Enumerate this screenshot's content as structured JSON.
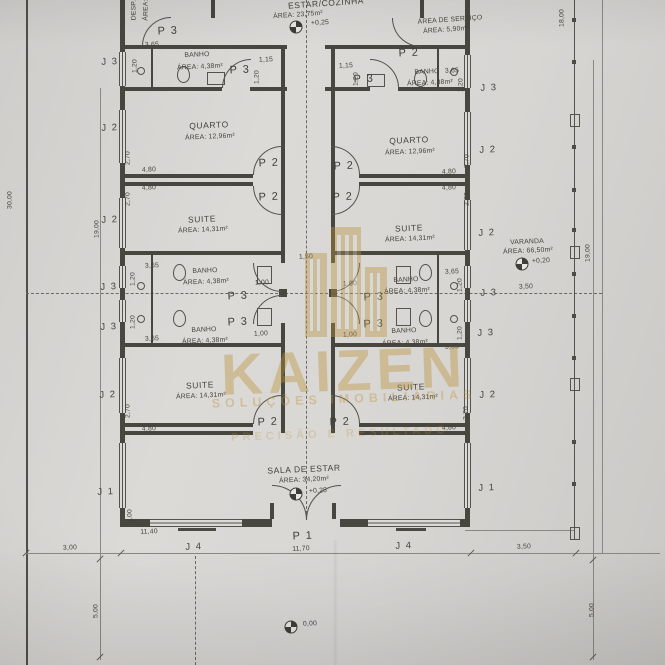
{
  "watermark": {
    "brand": "KAIZEN",
    "tagline": "SOLUÇÕES IMOBILIÁRIAS",
    "tagline2": "PRECISÃO E RESULTADO",
    "color": "#bb943c"
  },
  "plan": {
    "line_color": "#47463f",
    "paper_color": "#d8d6d3",
    "labels": [
      {
        "n": "room-despensa-name",
        "t": "DESP.",
        "x": 134,
        "y": 10,
        "r": -90,
        "k": "dim"
      },
      {
        "n": "room-despensa-area",
        "t": "ÁREA:",
        "x": 146,
        "y": 10,
        "r": -90,
        "k": "dim"
      },
      {
        "n": "room-estar-cozinha-name",
        "t": "ESTAR/COZINHA",
        "x": 326,
        "y": 3,
        "r": -4,
        "k": "room"
      },
      {
        "n": "room-estar-cozinha-area",
        "t": "ÁREA: 23,75m²",
        "x": 298,
        "y": 15,
        "r": -4,
        "k": "rs"
      },
      {
        "n": "level-label-estar",
        "t": "+0,25",
        "x": 320,
        "y": 23,
        "k": "rs"
      },
      {
        "n": "room-area-servico-name",
        "t": "ÁREA DE SERVIÇO",
        "x": 450,
        "y": 20,
        "r": -4,
        "k": "rs"
      },
      {
        "n": "room-area-servico-area",
        "t": "ÁREA: 5,90m²",
        "x": 446,
        "y": 30,
        "r": -4,
        "k": "rs"
      },
      {
        "n": "door-label-p3-despensa",
        "t": "P 3",
        "x": 168,
        "y": 31,
        "k": "pd"
      },
      {
        "n": "door-label-p2-servico",
        "t": "P 2",
        "x": 409,
        "y": 53,
        "k": "pd"
      },
      {
        "n": "room-banho-tl-name",
        "t": "BANHO",
        "x": 197,
        "y": 55,
        "k": "rs"
      },
      {
        "n": "room-banho-tl-area",
        "t": "ÁREA: 4,38m²",
        "x": 200,
        "y": 67,
        "k": "rs"
      },
      {
        "n": "room-banho-tr-name",
        "t": "BANHO",
        "x": 427,
        "y": 72,
        "k": "rs"
      },
      {
        "n": "room-banho-tr-area",
        "t": "ÁREA: 4,38m²",
        "x": 430,
        "y": 83,
        "k": "rs"
      },
      {
        "n": "door-label-p3-banho-tl",
        "t": "P 3",
        "x": 240,
        "y": 70,
        "k": "pd"
      },
      {
        "n": "door-label-p3-banho-tr",
        "t": "P 3",
        "x": 364,
        "y": 79,
        "k": "pd"
      },
      {
        "n": "dim-label",
        "t": "3,65",
        "x": 152,
        "y": 45,
        "k": "dim"
      },
      {
        "n": "dim-label",
        "t": "1,20",
        "x": 135,
        "y": 66,
        "r": -90,
        "k": "dim"
      },
      {
        "n": "dim-label",
        "t": "1,15",
        "x": 266,
        "y": 60,
        "k": "dim"
      },
      {
        "n": "dim-label",
        "t": "1,20",
        "x": 257,
        "y": 77,
        "r": -90,
        "k": "dim"
      },
      {
        "n": "dim-label",
        "t": "1,15",
        "x": 346,
        "y": 66,
        "k": "dim"
      },
      {
        "n": "dim-label",
        "t": "1,20",
        "x": 356,
        "y": 79,
        "r": -90,
        "k": "dim"
      },
      {
        "n": "dim-label",
        "t": "3,65",
        "x": 452,
        "y": 71,
        "k": "dim"
      },
      {
        "n": "dim-label",
        "t": "1,20",
        "x": 461,
        "y": 85,
        "r": -90,
        "k": "dim"
      },
      {
        "n": "window-label-j3",
        "t": "J 3",
        "x": 110,
        "y": 62,
        "k": "jl"
      },
      {
        "n": "window-label-j3",
        "t": "J 3",
        "x": 489,
        "y": 88,
        "k": "jl"
      },
      {
        "n": "room-quarto-left-name",
        "t": "QUARTO",
        "x": 209,
        "y": 125,
        "k": "room"
      },
      {
        "n": "room-quarto-left-area",
        "t": "ÁREA: 12,96m²",
        "x": 210,
        "y": 137,
        "k": "rs"
      },
      {
        "n": "room-quarto-right-name",
        "t": "QUARTO",
        "x": 409,
        "y": 140,
        "k": "room"
      },
      {
        "n": "room-quarto-right-area",
        "t": "ÁREA: 12,96m²",
        "x": 410,
        "y": 152,
        "k": "rs"
      },
      {
        "n": "window-label-j2",
        "t": "J 2",
        "x": 110,
        "y": 128,
        "k": "jl"
      },
      {
        "n": "window-label-j2",
        "t": "J 2",
        "x": 488,
        "y": 150,
        "k": "jl"
      },
      {
        "n": "dim-label",
        "t": "2,70",
        "x": 128,
        "y": 158,
        "r": -90,
        "k": "dim"
      },
      {
        "n": "dim-label",
        "t": "4,80",
        "x": 149,
        "y": 170,
        "k": "dim"
      },
      {
        "n": "dim-label",
        "t": "4,80",
        "x": 449,
        "y": 172,
        "k": "dim"
      },
      {
        "n": "dim-label",
        "t": "2,70",
        "x": 467,
        "y": 161,
        "r": -90,
        "k": "dim"
      },
      {
        "n": "door-label-p2-quarto-left",
        "t": "P 2",
        "x": 269,
        "y": 163,
        "k": "pd"
      },
      {
        "n": "door-label-p2-quarto-right",
        "t": "P 2",
        "x": 344,
        "y": 166,
        "k": "pd"
      },
      {
        "n": "door-label-p2-suite-left",
        "t": "P 2",
        "x": 269,
        "y": 197,
        "k": "pd"
      },
      {
        "n": "door-label-p2-suite-right",
        "t": "P 2",
        "x": 343,
        "y": 197,
        "k": "pd"
      },
      {
        "n": "dim-label",
        "t": "4,80",
        "x": 149,
        "y": 188,
        "k": "dim"
      },
      {
        "n": "dim-label",
        "t": "2,70",
        "x": 128,
        "y": 199,
        "r": -90,
        "k": "dim"
      },
      {
        "n": "dim-label",
        "t": "4,80",
        "x": 449,
        "y": 188,
        "k": "dim"
      },
      {
        "n": "dim-label",
        "t": "2,70",
        "x": 467,
        "y": 199,
        "r": -90,
        "k": "dim"
      },
      {
        "n": "room-suite-left1-name",
        "t": "SUITE",
        "x": 202,
        "y": 219,
        "k": "room"
      },
      {
        "n": "room-suite-left1-area",
        "t": "ÁREA: 14,31m²",
        "x": 203,
        "y": 230,
        "k": "rs"
      },
      {
        "n": "room-suite-right1-name",
        "t": "SUITE",
        "x": 409,
        "y": 228,
        "k": "room"
      },
      {
        "n": "room-suite-right1-area",
        "t": "ÁREA: 14,31m²",
        "x": 410,
        "y": 239,
        "k": "rs"
      },
      {
        "n": "window-label-j2",
        "t": "J 2",
        "x": 110,
        "y": 220,
        "k": "jl"
      },
      {
        "n": "window-label-j2",
        "t": "J 2",
        "x": 487,
        "y": 233,
        "k": "jl"
      },
      {
        "n": "dim-label",
        "t": "19,00",
        "x": 97,
        "y": 229,
        "r": -90,
        "k": "dim"
      },
      {
        "n": "dim-label",
        "t": "1,50",
        "x": 306,
        "y": 257,
        "k": "dim"
      },
      {
        "n": "dim-label",
        "t": "3,65",
        "x": 152,
        "y": 266,
        "k": "dim"
      },
      {
        "n": "dim-label",
        "t": "1,20",
        "x": 133,
        "y": 279,
        "r": -90,
        "k": "dim"
      },
      {
        "n": "room-banho-ml1-name",
        "t": "BANHO",
        "x": 205,
        "y": 271,
        "k": "rs"
      },
      {
        "n": "room-banho-ml1-area",
        "t": "ÁREA: 4,38m²",
        "x": 206,
        "y": 282,
        "k": "rs"
      },
      {
        "n": "room-banho-mr1-name",
        "t": "BANHO",
        "x": 406,
        "y": 280,
        "k": "rs"
      },
      {
        "n": "room-banho-mr1-area",
        "t": "ÁREA: 4,38m²",
        "x": 407,
        "y": 291,
        "k": "rs"
      },
      {
        "n": "dim-label",
        "t": "1,00",
        "x": 262,
        "y": 283,
        "k": "dim"
      },
      {
        "n": "dim-label",
        "t": "1,00",
        "x": 350,
        "y": 284,
        "k": "dim"
      },
      {
        "n": "dim-label",
        "t": "3,65",
        "x": 452,
        "y": 272,
        "k": "dim"
      },
      {
        "n": "dim-label",
        "t": "1,20",
        "x": 460,
        "y": 285,
        "r": -90,
        "k": "dim"
      },
      {
        "n": "window-label-j3",
        "t": "J 3",
        "x": 109,
        "y": 287,
        "k": "jl"
      },
      {
        "n": "window-label-j3",
        "t": "J 3",
        "x": 489,
        "y": 293,
        "k": "jl"
      },
      {
        "n": "door-label-p3-banho-ml1",
        "t": "P 3",
        "x": 238,
        "y": 296,
        "k": "pd"
      },
      {
        "n": "door-label-p3-banho-mr1",
        "t": "P 3",
        "x": 374,
        "y": 297,
        "k": "pd"
      },
      {
        "n": "door-label-p3-banho-ml2",
        "t": "P 3",
        "x": 238,
        "y": 322,
        "k": "pd"
      },
      {
        "n": "door-label-p3-banho-mr2",
        "t": "P 3",
        "x": 374,
        "y": 324,
        "k": "pd"
      },
      {
        "n": "room-banho-ml2-name",
        "t": "BANHO",
        "x": 204,
        "y": 330,
        "k": "rs"
      },
      {
        "n": "room-banho-ml2-area",
        "t": "ÁREA: 4,38m²",
        "x": 205,
        "y": 341,
        "k": "rs"
      },
      {
        "n": "room-banho-mr2-name",
        "t": "BANHO",
        "x": 404,
        "y": 331,
        "k": "rs"
      },
      {
        "n": "room-banho-mr2-area",
        "t": "ÁREA: 4,38m²",
        "x": 405,
        "y": 343,
        "k": "rs"
      },
      {
        "n": "dim-label",
        "t": "1,20",
        "x": 133,
        "y": 322,
        "r": -90,
        "k": "dim"
      },
      {
        "n": "dim-label",
        "t": "3,65",
        "x": 152,
        "y": 339,
        "k": "dim"
      },
      {
        "n": "dim-label",
        "t": "1,00",
        "x": 261,
        "y": 334,
        "k": "dim"
      },
      {
        "n": "dim-label",
        "t": "1,00",
        "x": 350,
        "y": 335,
        "k": "dim"
      },
      {
        "n": "dim-label",
        "t": "1,20",
        "x": 460,
        "y": 333,
        "r": -90,
        "k": "dim"
      },
      {
        "n": "dim-label",
        "t": "3,65",
        "x": 452,
        "y": 347,
        "k": "dim"
      },
      {
        "n": "window-label-j3",
        "t": "J 3",
        "x": 109,
        "y": 327,
        "k": "jl"
      },
      {
        "n": "window-label-j3",
        "t": "J 3",
        "x": 486,
        "y": 333,
        "k": "jl"
      },
      {
        "n": "room-suite-left2-name",
        "t": "SUITE",
        "x": 200,
        "y": 385,
        "k": "room"
      },
      {
        "n": "room-suite-left2-area",
        "t": "ÁREA: 14,31m²",
        "x": 201,
        "y": 396,
        "k": "rs"
      },
      {
        "n": "room-suite-right2-name",
        "t": "SUITE",
        "x": 411,
        "y": 387,
        "k": "room"
      },
      {
        "n": "room-suite-right2-area",
        "t": "ÁREA: 14,31m²",
        "x": 413,
        "y": 398,
        "k": "rs"
      },
      {
        "n": "window-label-j2",
        "t": "J 2",
        "x": 108,
        "y": 395,
        "k": "jl"
      },
      {
        "n": "window-label-j2",
        "t": "J 2",
        "x": 488,
        "y": 395,
        "k": "jl"
      },
      {
        "n": "dim-label",
        "t": "2,70",
        "x": 128,
        "y": 411,
        "r": -90,
        "k": "dim"
      },
      {
        "n": "dim-label",
        "t": "4,80",
        "x": 149,
        "y": 429,
        "k": "dim"
      },
      {
        "n": "dim-label",
        "t": "2,70",
        "x": 466,
        "y": 413,
        "r": -90,
        "k": "dim"
      },
      {
        "n": "dim-label",
        "t": "4,80",
        "x": 449,
        "y": 428,
        "k": "dim"
      },
      {
        "n": "door-label-p2-sala-left",
        "t": "P 2",
        "x": 268,
        "y": 422,
        "k": "pd"
      },
      {
        "n": "door-label-p2-sala-right",
        "t": "P 2",
        "x": 340,
        "y": 422,
        "k": "pd"
      },
      {
        "n": "room-sala-name",
        "t": "SALA DE ESTAR",
        "x": 304,
        "y": 469,
        "k": "room"
      },
      {
        "n": "room-sala-area",
        "t": "ÁREA: 34,20m²",
        "x": 304,
        "y": 480,
        "k": "rs"
      },
      {
        "n": "level-label-sala",
        "t": "+0,25",
        "x": 318,
        "y": 491,
        "k": "rs"
      },
      {
        "n": "window-label-j1",
        "t": "J 1",
        "x": 106,
        "y": 492,
        "k": "jl"
      },
      {
        "n": "window-label-j1",
        "t": "J 1",
        "x": 487,
        "y": 488,
        "k": "jl"
      },
      {
        "n": "dim-label",
        "t": "3,00",
        "x": 130,
        "y": 516,
        "r": -90,
        "k": "dim"
      },
      {
        "n": "dim-label",
        "t": "11,40",
        "x": 149,
        "y": 532,
        "k": "dim"
      },
      {
        "n": "door-label-p1-entrada",
        "t": "P 1",
        "x": 303,
        "y": 536,
        "k": "pd"
      },
      {
        "n": "window-label-j4",
        "t": "J 4",
        "x": 194,
        "y": 547,
        "k": "jl"
      },
      {
        "n": "window-label-j4",
        "t": "J 4",
        "x": 404,
        "y": 546,
        "k": "jl"
      },
      {
        "n": "room-varanda-name",
        "t": "VARANDA",
        "x": 527,
        "y": 242,
        "k": "rs"
      },
      {
        "n": "room-varanda-area",
        "t": "ÁREA: 66,50m²",
        "x": 528,
        "y": 251,
        "k": "rs"
      },
      {
        "n": "level-label-varanda",
        "t": "+0,20",
        "x": 541,
        "y": 261,
        "k": "rs"
      },
      {
        "n": "dim-label",
        "t": "3,50",
        "x": 526,
        "y": 287,
        "k": "dim"
      },
      {
        "n": "dim-label",
        "t": "19,00",
        "x": 588,
        "y": 253,
        "r": -90,
        "k": "dim"
      },
      {
        "n": "dim-label",
        "t": "18,00",
        "x": 562,
        "y": 18,
        "r": -90,
        "k": "dim"
      },
      {
        "n": "dim-label",
        "t": "30,00",
        "x": 10,
        "y": 200,
        "r": -90,
        "k": "dim"
      },
      {
        "n": "dim-label",
        "t": "3,00",
        "x": 70,
        "y": 548,
        "k": "dim"
      },
      {
        "n": "dim-label",
        "t": "11,70",
        "x": 301,
        "y": 549,
        "k": "dim"
      },
      {
        "n": "dim-label",
        "t": "3,50",
        "x": 524,
        "y": 547,
        "k": "dim"
      },
      {
        "n": "dim-label",
        "t": "5,00",
        "x": 96,
        "y": 611,
        "r": -90,
        "k": "dim"
      },
      {
        "n": "dim-label",
        "t": "5,00",
        "x": 592,
        "y": 610,
        "r": -90,
        "k": "dim"
      },
      {
        "n": "level-label-terreno",
        "t": "0,00",
        "x": 310,
        "y": 624,
        "k": "rs"
      }
    ]
  }
}
